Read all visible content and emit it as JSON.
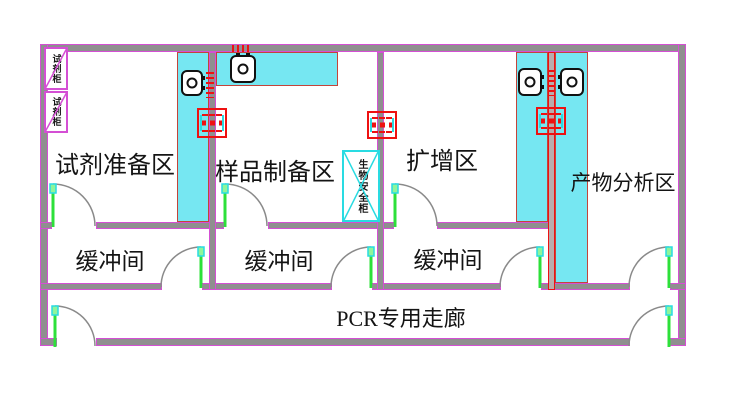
{
  "diagram_type": "pcr-lab-floor-plan",
  "rooms": [
    {
      "label": "试剂准备区"
    },
    {
      "label": "样品制备区"
    },
    {
      "label": "扩增区"
    },
    {
      "label": "产物分析区"
    }
  ],
  "buffer_rooms": [
    {
      "label": "缓冲间"
    },
    {
      "label": "缓冲间"
    },
    {
      "label": "缓冲间"
    }
  ],
  "corridor": {
    "label": "PCR专用走廊"
  },
  "cabinets": [
    {
      "label": "试剂柜"
    },
    {
      "label": "试剂柜"
    }
  ],
  "biosafety_cabinet": {
    "label": "生物安全柜"
  },
  "icons": {
    "instrument": "instrument-icon (rounded box with circular rotor)",
    "pass_box": "pass-box-icon (red transfer window on wall)",
    "air_vent": "air-vent-icon (red dashed grille)",
    "door": "door-arc (quarter-circle swing with green leaf)"
  },
  "colors": {
    "wall_edge": "#d44fd4",
    "wall_fill": "#8f8f8f",
    "bench_cyan": "#76e7f2",
    "bench_edge": "#c3443a",
    "pass_red": "#ee1111",
    "door_green": "#2de03a",
    "arc_gray": "#8a8a8a",
    "cyan_line": "#29dbe2",
    "text": "#141414"
  }
}
